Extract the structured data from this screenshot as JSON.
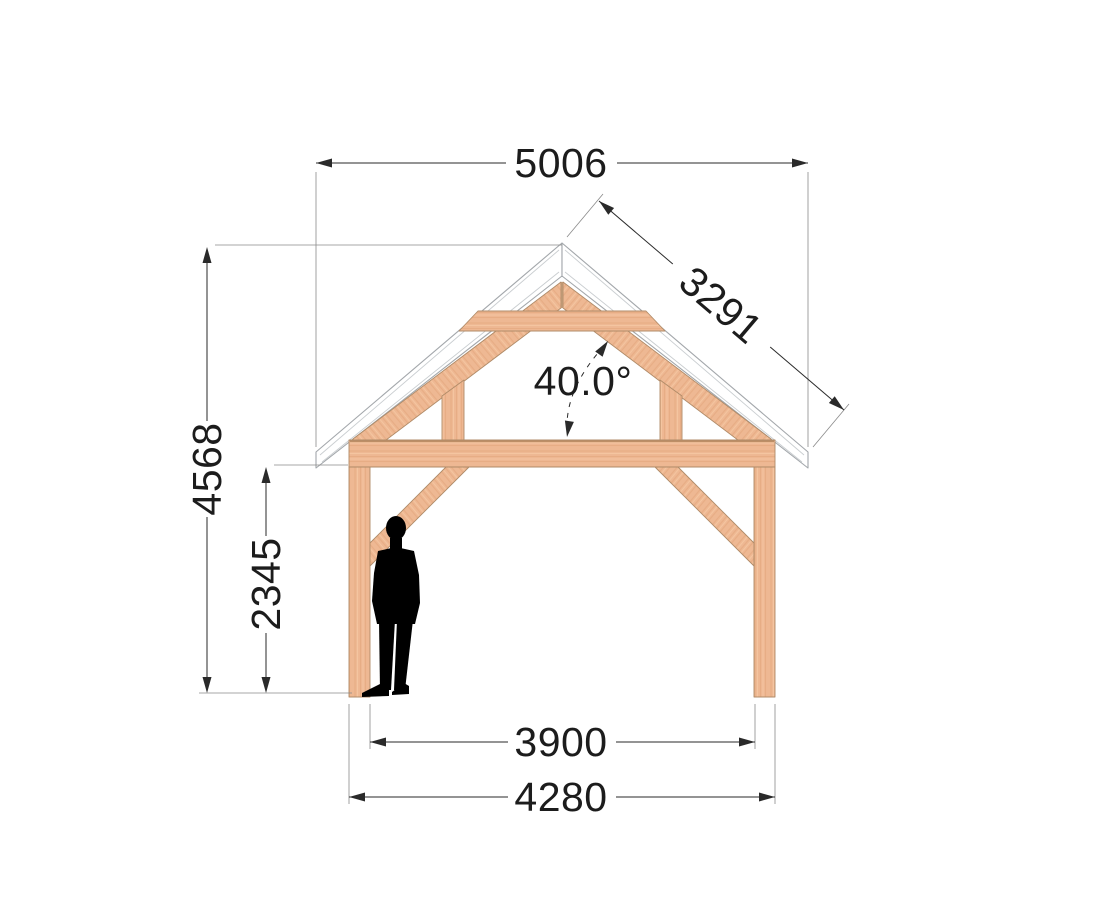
{
  "drawing": {
    "dimensions": {
      "overall_width": "5006",
      "rafter_length": "3291",
      "roof_angle": "40.0°",
      "overall_height": "4568",
      "clearance_height": "2345",
      "inner_span": "3900",
      "outer_span": "4280"
    },
    "colors": {
      "wood": "#eeb893",
      "wood_grain_dark": "#dfa277",
      "wood_grain_light": "#f7cda8",
      "wood_edge": "#b08b68",
      "roof_fill": "#ffffff",
      "roof_edge": "#a3a7ab",
      "dimension_line": "#2a2a2a",
      "extension_line": "#8a8a8a",
      "text": "#1c1c1c",
      "silhouette": "#000000"
    }
  }
}
